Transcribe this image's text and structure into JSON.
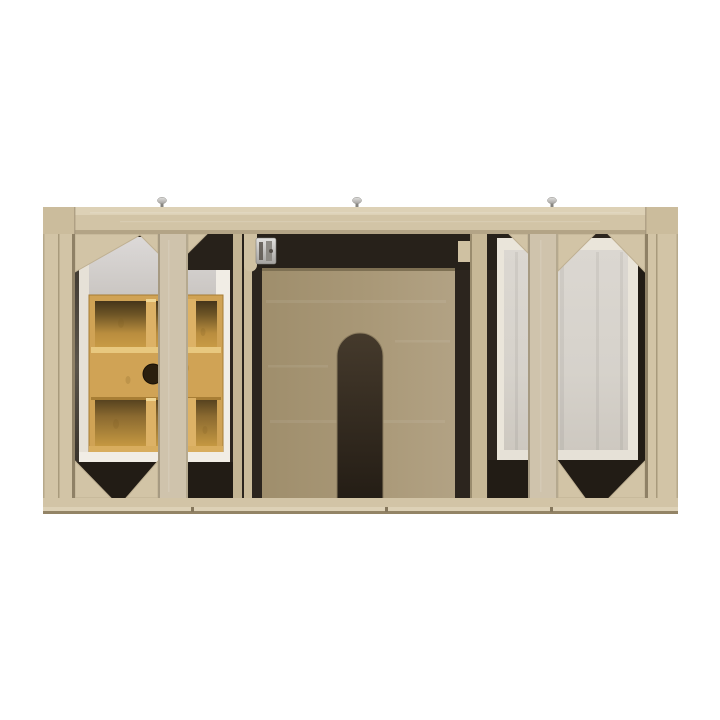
{
  "photo": {
    "description": "Front view of an open light-oak bathroom vanity cabinet: left bay holds a white drawer box with a bamboo drawer organizer (round finger hole in the sliding tray), center shows a plywood back panel with an arched plumbing cutout, right bay shows a grey drawer side panel behind a face frame with diagonal corner braces; three metal glides sit on the top rail."
  },
  "colors": {
    "background": "#ffffff",
    "frame_wood": "#d2c4a6",
    "frame_wood_light": "#ddd1b6",
    "frame_wood_dark": "#b3a486",
    "frame_edge_line": "#938466",
    "corner_block": "#cbbc9c",
    "stile_wood": "#cfc3ac",
    "strip_wood": "#c4b594",
    "interior_dark": "#2c251e",
    "interior_darker": "#221c15",
    "shadow_strip": "#27211a",
    "plywood": "#a89774",
    "arch_dark": "#352c21",
    "bamboo_face": "#d0a355",
    "bamboo_light": "#e8c87f",
    "bamboo_rim": "#d8ad5e",
    "bamboo_divider": "#ddb266",
    "bamboo_dark": "#a67c33",
    "finger_hole": "#2b1f0e",
    "drawer_white": "#f1ede5",
    "drawer_white_dim": "#e6e1d7",
    "wall_gray": "#d6d3d2",
    "side_panel_gray": "#d7d3cc",
    "cream_edge": "#eae5da",
    "metal_silver": "#c9c8c5",
    "metal_shadow": "#86847f",
    "tab_wood": "#cfc1a2"
  }
}
